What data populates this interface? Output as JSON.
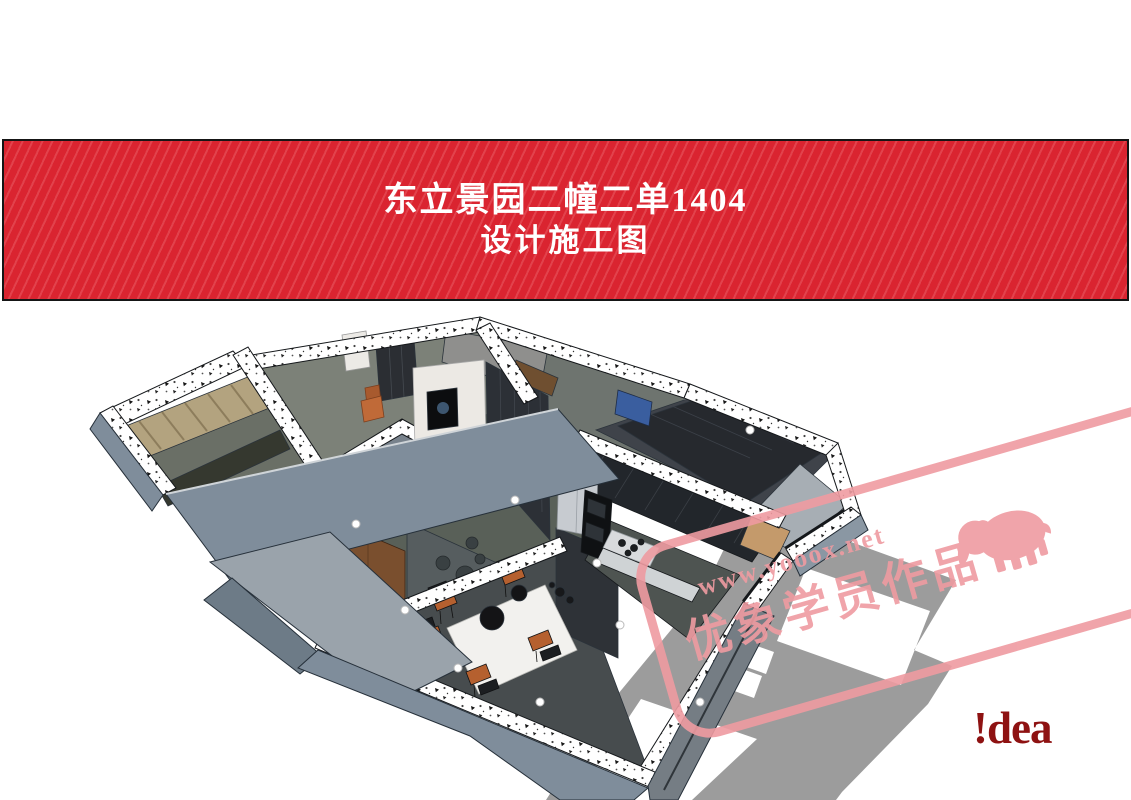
{
  "banner": {
    "title_line1": "东立景园二幢二单1404",
    "title_line2": "设计施工图",
    "background_color": "#da2430",
    "stripe_color": "#e2424c",
    "border_color": "#151515",
    "text_color": "#ffffff"
  },
  "floorplan": {
    "type": "3d-sketchup-cutaway-floorplan",
    "colors": {
      "wall_face_blue_gray": "#7f8d9b",
      "wall_face_light": "#9aa3ab",
      "wall_cut_speckled": "#ffffff",
      "floor_slab_gray": "#9c9c9c",
      "room_floor_dark": "#474c4e",
      "dark_cabinetry": "#22262b",
      "wood_door": "#7a4f2e",
      "curtain_tan": "#b3a37f",
      "marble_tv_wall": "#ece9e4",
      "balcony_wood": "#c49a6b",
      "accent_chair_orange": "#c06a38",
      "tv_screen_blue": "#3a5e9f",
      "fridge_steel": "#c7cbd0"
    },
    "areas": [
      "bedroom-with-curtains",
      "wardrobe-room",
      "bathroom-box",
      "living-room-tv-wall",
      "dining-room",
      "kitchen",
      "balcony",
      "bedroom-right",
      "floor-slab"
    ]
  },
  "watermark": {
    "url_text": "www.yooox.net",
    "brand_text": "优象学员作品",
    "color": "#ef9ba1",
    "icon": "elephant-silhouette"
  },
  "logo": {
    "text": "!dea",
    "color": "#8e1212"
  }
}
